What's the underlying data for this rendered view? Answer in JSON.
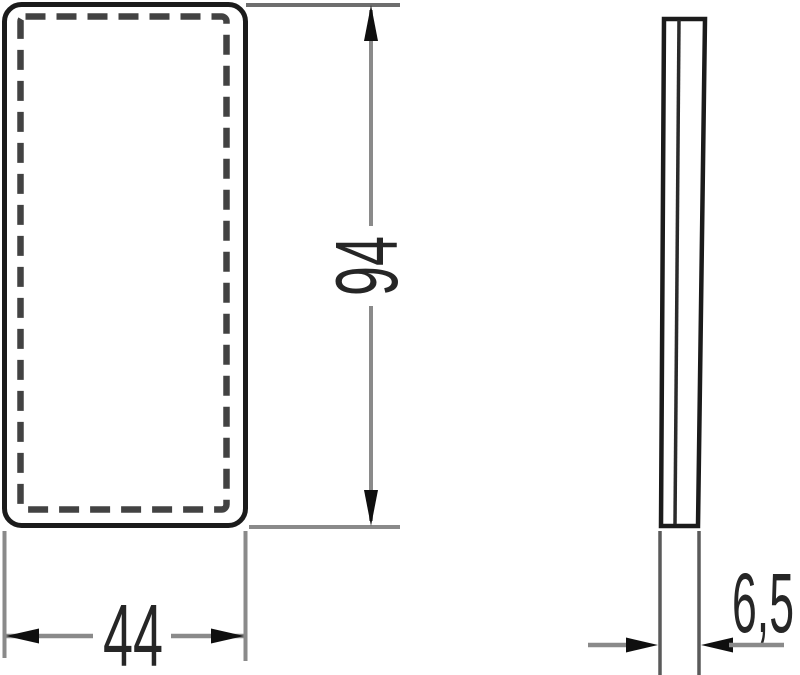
{
  "drawing": {
    "type": "technical-dimension-drawing",
    "background_color": "#ffffff",
    "outline_color": "#1b1b1b",
    "dashed_line_color": "#424242",
    "dimension_line_color": "#8a8a8a",
    "extension_line_color": "#6e6e6e",
    "arrow_color": "#0f0f0f",
    "text_color": "#262626",
    "views": {
      "front": {
        "name": "front-view-rounded-rectangle"
      },
      "side": {
        "name": "side-profile-view"
      }
    },
    "dimensions": {
      "width": "44",
      "height": "94",
      "depth": "6,5"
    }
  }
}
